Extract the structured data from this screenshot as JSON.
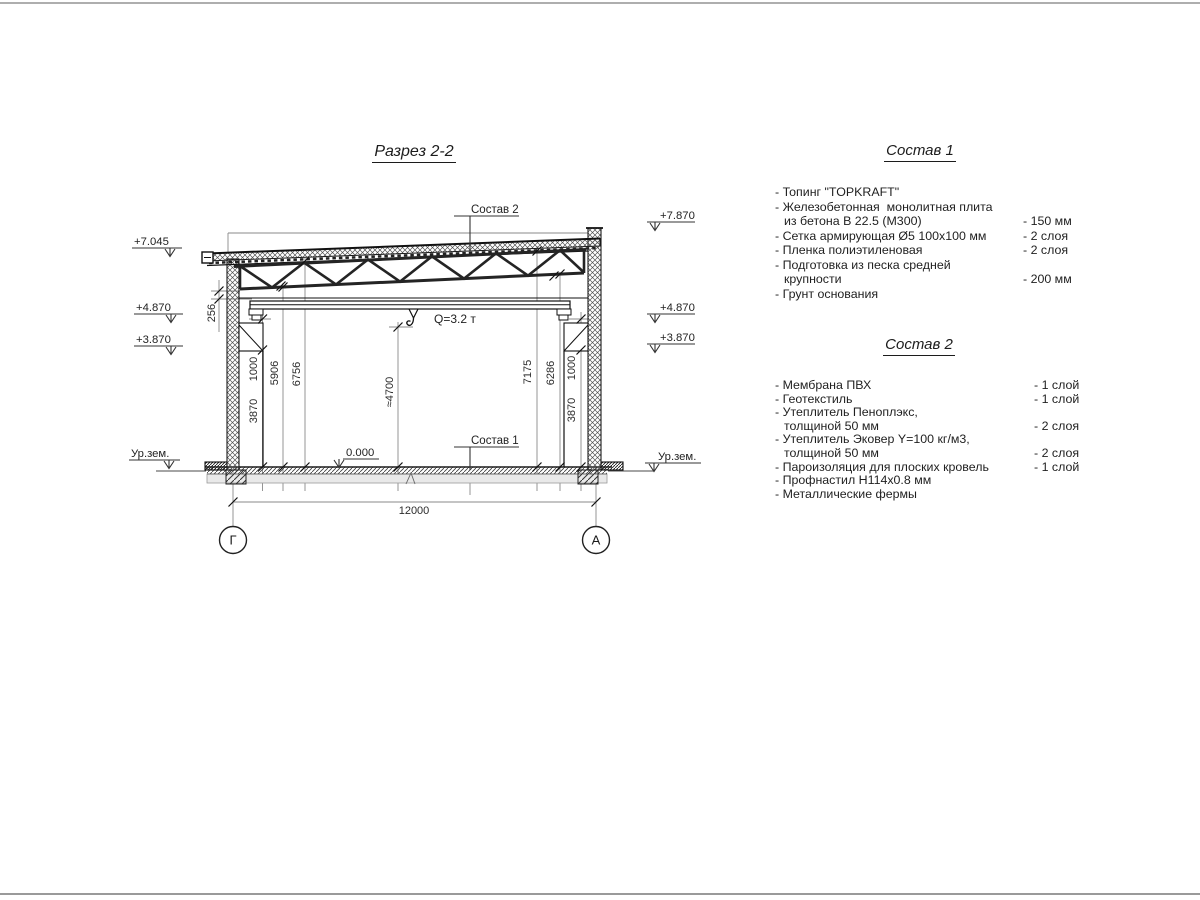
{
  "page": {
    "title": "Разрез 2-2"
  },
  "section_view": {
    "callouts": {
      "roof": "Состав 2",
      "floor": "Состав 1"
    },
    "crane": {
      "label": "Q=3.2 т"
    },
    "elevations": {
      "left_roof": "+7.045",
      "left_beam": "+4.870",
      "left_corbel": "+3.870",
      "right_parapet": "+7.870",
      "right_beam": "+4.870",
      "right_corbel": "+3.870",
      "floor": "0.000",
      "ground_left": "Ур.зем.",
      "ground_right": "Ур.зем."
    },
    "dimensions": {
      "truss_gap": "256",
      "left_corbel_to_beam": "1000",
      "left_floor_to_corbel": "3870",
      "left_floor_to_truss": "5906",
      "left_floor_to_roof": "6756",
      "hook_height": "≈4700",
      "right_floor_to_roof": "7175",
      "right_floor_to_truss": "6286",
      "right_corbel_to_beam": "1000",
      "right_floor_to_corbel": "3870",
      "span": "12000"
    },
    "axes": {
      "left": "Г",
      "right": "А"
    }
  },
  "composition1": {
    "heading": "Состав 1",
    "rows": [
      {
        "text": "- Топинг \"TOPKRAFT\"",
        "value": ""
      },
      {
        "text": "- Железобетонная  монолитная плита",
        "value": ""
      },
      {
        "text": "из бетона В 22.5 (М300)",
        "value": "- 150 мм"
      },
      {
        "text": "- Сетка армирующая Ø5 100x100 мм",
        "value": "- 2 слоя"
      },
      {
        "text": "- Пленка полиэтиленовая",
        "value": "- 2 слоя"
      },
      {
        "text": "- Подготовка из песка средней",
        "value": ""
      },
      {
        "text": "крупности",
        "value": "- 200 мм"
      },
      {
        "text": "- Грунт основания",
        "value": ""
      }
    ]
  },
  "composition2": {
    "heading": "Состав 2",
    "rows": [
      {
        "text": "- Мембрана ПВХ",
        "value": "- 1 слой"
      },
      {
        "text": "- Геотекстиль",
        "value": "- 1 слой"
      },
      {
        "text": "- Утеплитель Пеноплэкс,",
        "value": ""
      },
      {
        "text": "толщиной 50 мм",
        "value": "- 2 слоя"
      },
      {
        "text": "- Утеплитель Эковер Y=100 кг/м3,",
        "value": ""
      },
      {
        "text": "толщиной 50 мм",
        "value": "- 2 слоя"
      },
      {
        "text": "- Пароизоляция для плоских кровель",
        "value": "- 1 слой"
      },
      {
        "text": "- Профнастил Н114x0.8 мм",
        "value": ""
      },
      {
        "text": "- Металлические фермы",
        "value": ""
      }
    ]
  }
}
